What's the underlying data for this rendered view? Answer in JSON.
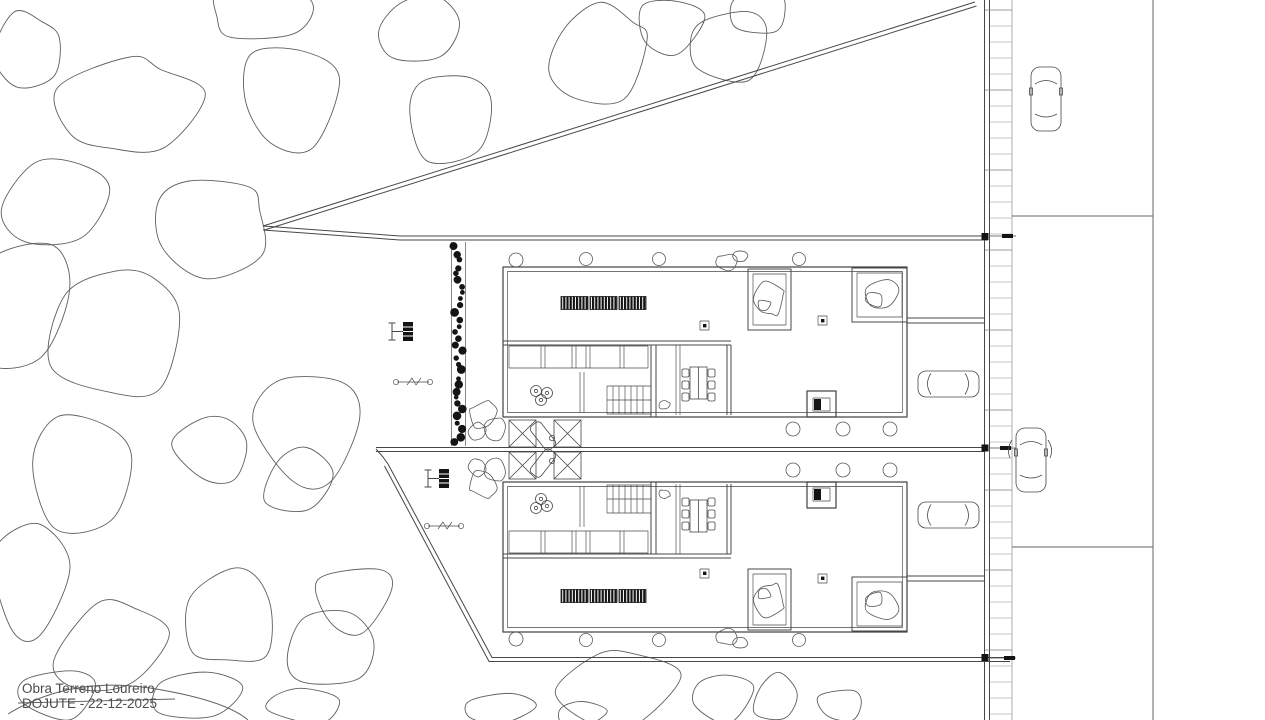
{
  "title_block": {
    "project": "Obra Terreno Loureiro",
    "author_date": "DOJUTE - 22-12-2025"
  },
  "canvas": {
    "background": "#ffffff",
    "line_color": "#474747",
    "light_line_color": "#9a9a9a",
    "dark_fill": "#141414",
    "road_line_color": "#666666",
    "text_color": "#4d4d4d"
  }
}
